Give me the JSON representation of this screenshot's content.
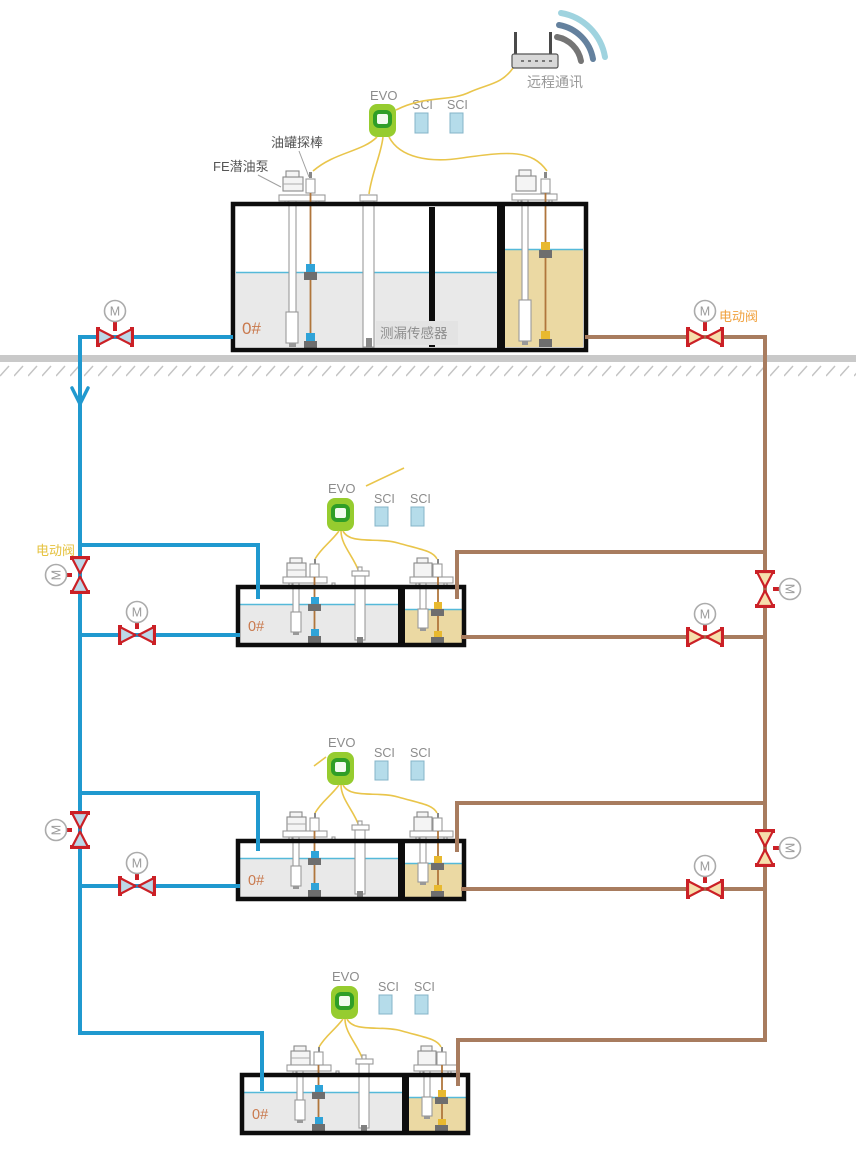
{
  "colors": {
    "pipe_blue": "#2099CF",
    "pipe_brown": "#A87C5F",
    "valve_red": "#CB2026",
    "valve_fill_blue": "#BCD8E8",
    "valve_fill_tan": "#F6DFAC",
    "evo_green": "#96CC2F",
    "evo_inner_green": "#2F9E27",
    "sci_fill": "#B5DCEA",
    "sci_border": "#85B4C8",
    "tank_fill_gray": "#E9E9E9",
    "oil_fill": "#EBD9A3",
    "liquid_line": "#55B9D9",
    "ground_gray": "#C9C9C9",
    "wire_yellow": "#E9C54B",
    "probe_wire": "#B0763C",
    "grade_text": "#C9794D",
    "label_gray": "#8C8C8C",
    "label_dark": "#555555",
    "valve_label_orange": "#F0A13E",
    "valve_label_yellow": "#E5C23E",
    "tank_border": "#0D0D0D"
  },
  "remote": {
    "label": "远程通讯"
  },
  "devices": {
    "evo": "EVO",
    "sci": "SCI"
  },
  "labels": {
    "tank_probe": "油罐探棒",
    "submersible_pump": "FE潜油泵",
    "leak_sensor": "测漏传感器",
    "electric_valve": "电动阀",
    "motor": "M",
    "fuel_grade": "0#"
  }
}
